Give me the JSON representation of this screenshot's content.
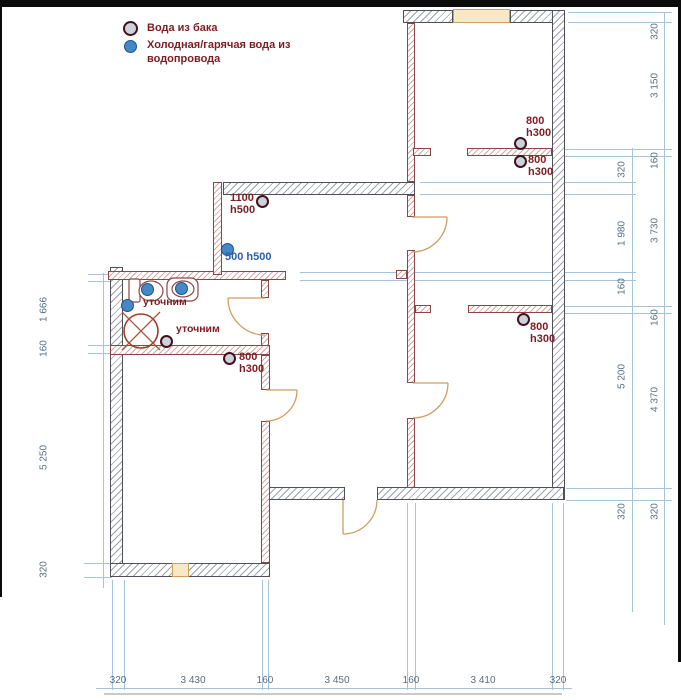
{
  "legend": {
    "tank_label": "Вода из бака",
    "supply_label_line1": "Холодная/гарячая вода из",
    "supply_label_line2": "водопровода"
  },
  "labels": {
    "p1100": {
      "l1": "1100",
      "l2": "h500"
    },
    "p500": "500 h500",
    "utochnim_a": "уточним",
    "utochnim_b": "уточним",
    "p800_bath": {
      "l1": "800",
      "l2": "h300"
    },
    "p800_top_a": {
      "l1": "800",
      "l2": "h300"
    },
    "p800_top_b": {
      "l1": "800",
      "l2": "h300"
    },
    "p800_mid": {
      "l1": "800",
      "l2": "h300"
    }
  },
  "dimensions": {
    "bottom": [
      "320",
      "3 430",
      "160",
      "3 450",
      "160",
      "3 410",
      "320"
    ],
    "left": [
      "1 666",
      "160",
      "5 250",
      "320"
    ],
    "right_outer": [
      "320",
      "3 150",
      "160",
      "3 730",
      "160",
      "4 370",
      "320"
    ],
    "right_inner": [
      "320",
      "1 980",
      "160",
      "5 200",
      "320"
    ]
  },
  "colors": {
    "wall_outline": "#50505a",
    "partition_outline": "#8b4545",
    "dimension_line": "#a5c4da",
    "dimension_text": "#5a6e80",
    "annotation_red": "#7c1d22",
    "annotation_blue": "#2a5fa8",
    "supply_point": "#4289c6",
    "tank_point_fill": "#cdd1d9",
    "tank_point_ring": "#44101e",
    "door_arc": "#cf9d62",
    "window_fill": "#f8e8c8"
  }
}
